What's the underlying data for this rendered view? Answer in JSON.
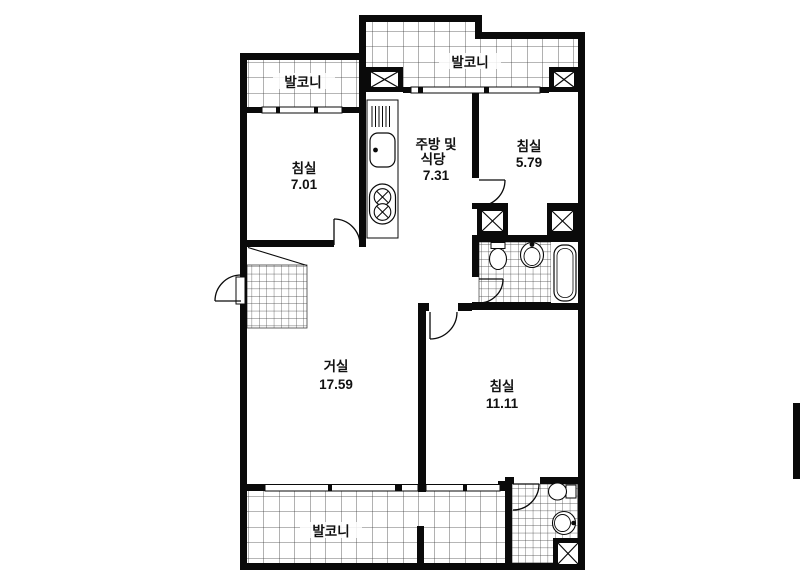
{
  "plan": {
    "type": "apartment-floor-plan",
    "rooms": {
      "bedroom_nw": {
        "name": "침실",
        "area": "7.01"
      },
      "kitchen_dining": {
        "name_line1": "주방 및",
        "name_line2": "식당",
        "area": "7.31"
      },
      "bedroom_ne": {
        "name": "침실",
        "area": "5.79"
      },
      "living_room": {
        "name": "거실",
        "area": "17.59"
      },
      "bedroom_se": {
        "name": "침실",
        "area": "11.11"
      },
      "balcony_west": {
        "name": "발코니"
      },
      "balcony_north": {
        "name": "발코니"
      },
      "balcony_south": {
        "name": "발코니"
      }
    },
    "colors": {
      "wall": "#0a0a0a",
      "background": "#ffffff",
      "grid_line": "#3c3c3c"
    }
  }
}
